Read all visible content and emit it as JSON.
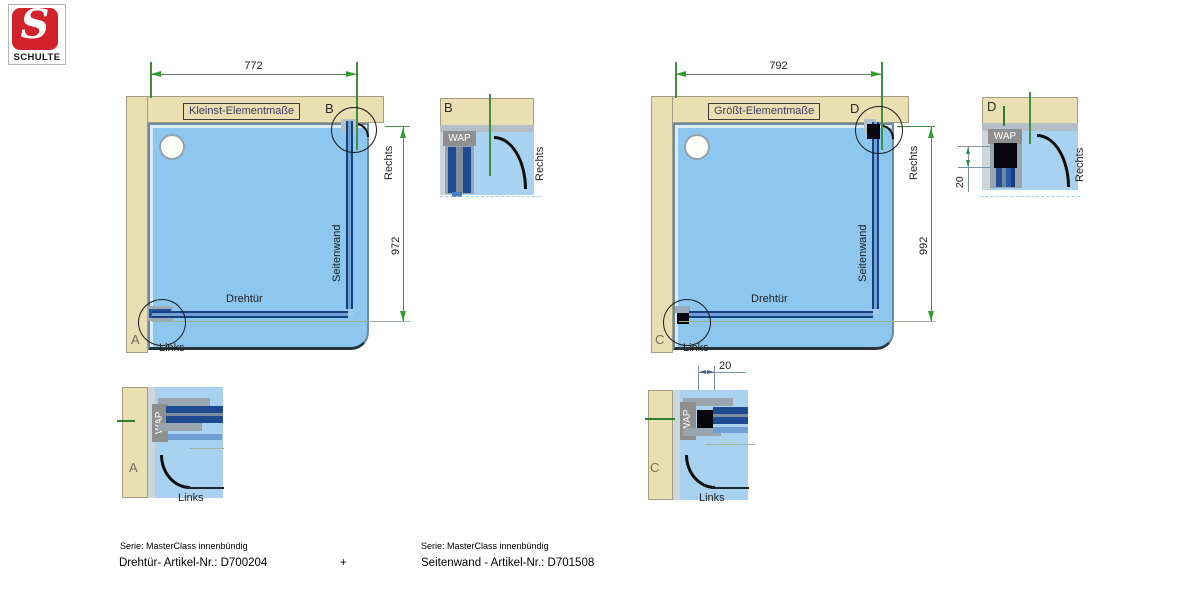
{
  "logo": {
    "letter": "S",
    "brand": "SCHULTE"
  },
  "left_diagram": {
    "title": "Kleinst-Elementmaße",
    "width_dim": "772",
    "height_dim": "972",
    "door": "Drehtür",
    "sidewall": "Seitenwand",
    "rechts": "Rechts",
    "links": "Links",
    "detail_top_letter": "B",
    "detail_bottom_letter": "A"
  },
  "right_diagram": {
    "title": "Größt-Elementmaße",
    "width_dim": "792",
    "height_dim": "992",
    "door": "Drehtür",
    "sidewall": "Seitenwand",
    "rechts": "Rechts",
    "links": "Links",
    "detail_top_letter": "D",
    "detail_bottom_letter": "C",
    "gap_dim": "20"
  },
  "detail_b": {
    "letter": "B",
    "wap": "WAP",
    "side": "Rechts"
  },
  "detail_d": {
    "letter": "D",
    "wap": "WAP",
    "side": "Rechts",
    "gap": "20"
  },
  "detail_a": {
    "letter": "A",
    "wap": "WAP",
    "side": "Links"
  },
  "detail_c": {
    "letter": "C",
    "wap": "WAP",
    "side": "Links",
    "gap": "20"
  },
  "footer": {
    "left_series": "Serie: MasterClass innenbündig",
    "left_article": "Drehtür- Artikel-Nr.: D700204",
    "plus": "+",
    "right_series": "Serie: MasterClass innenbündig",
    "right_article": "Seitenwand - Artikel-Nr.: D701508"
  },
  "colors": {
    "wall": "#eadfb2",
    "tray_blue": "#8dc6ef",
    "glass_blue": "#16407e",
    "dimension_green": "#2e9e2e",
    "logo_red": "#d2232a"
  }
}
